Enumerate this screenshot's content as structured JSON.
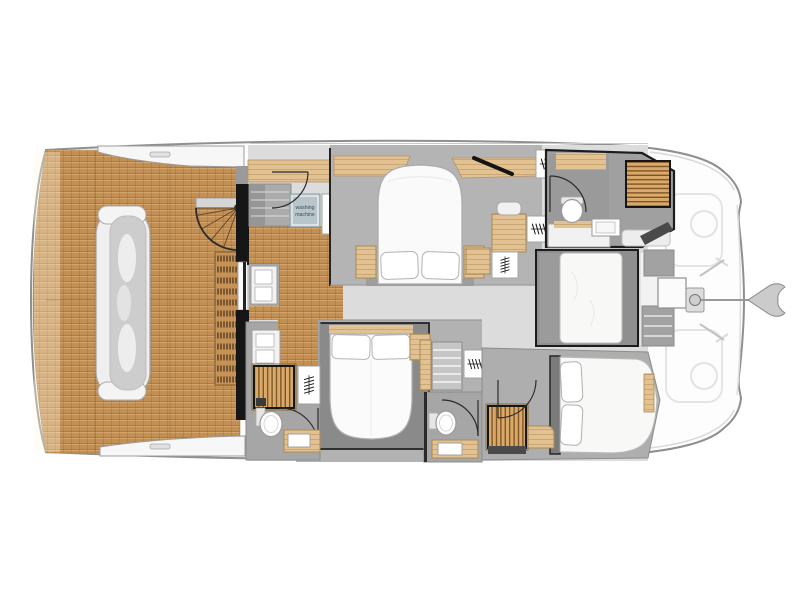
{
  "canvas": {
    "width": 797,
    "height": 597,
    "background": "#ffffff"
  },
  "labels": {
    "washing_machine_line1": "washing",
    "washing_machine_line2": "machine"
  },
  "palette": {
    "teak": "#C28F55",
    "light_wood": "#E2C193",
    "slat_wood": "#D9AA6C",
    "slat_wood_dark": "#7D5524",
    "floor_gray": "#B5B5B5",
    "furniture_gray": "#8A8A8A",
    "wall_black": "#1A1A1A",
    "bed_white": "#FAFAFA",
    "hull_fill": "#FDFDFD",
    "hull_stroke": "#8F8F8F",
    "washer_box": "#B8C5CA"
  },
  "plan": {
    "type": "floorplan",
    "subject": "catamaran yacht deck plan",
    "orientation": "bow-right",
    "rooms": [
      "aft-deck-cockpit",
      "salon-galley",
      "cabin-upper",
      "bathroom-upper-right",
      "berth-mid-right",
      "bow-anchor-area",
      "cabin-lower",
      "bathroom-lower-left",
      "bathroom-lower-center",
      "cabin-lower-right"
    ],
    "fixtures": [
      "sofa",
      "spiral-staircase",
      "stairs",
      "double-bed",
      "pillows",
      "wardrobe-hangers",
      "washing-machine",
      "toilet",
      "sink",
      "shower-grating",
      "anchor",
      "teak-decking"
    ]
  }
}
